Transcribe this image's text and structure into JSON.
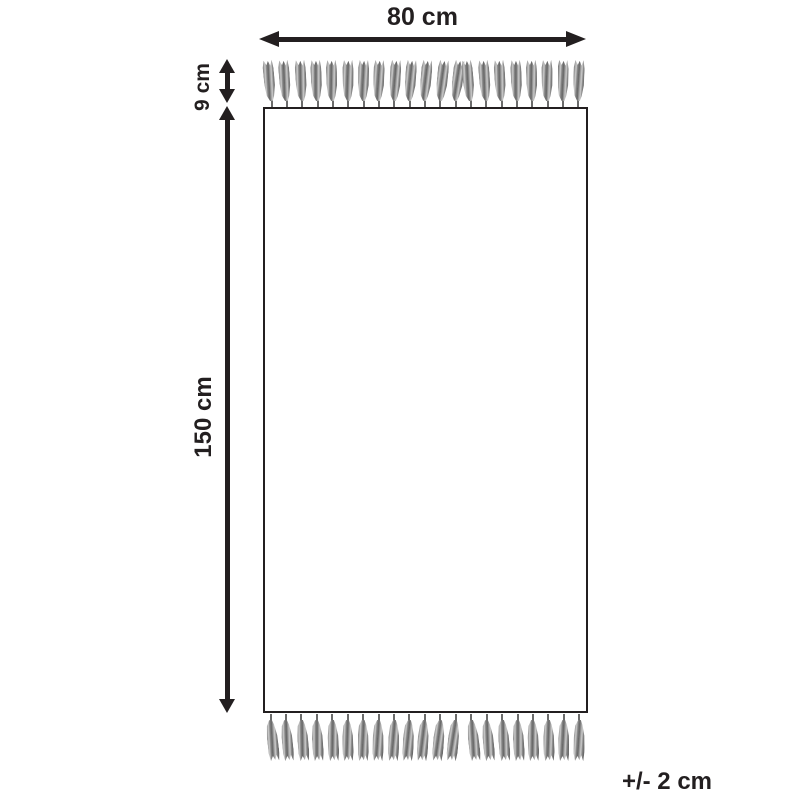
{
  "diagram": {
    "width_dimension": {
      "label": "80 cm"
    },
    "fringe_dimension": {
      "label": "9 cm"
    },
    "height_dimension": {
      "label": "150 cm"
    },
    "tolerance": {
      "label": "+/- 2 cm"
    },
    "fringe": {
      "top_tassel_count": 21,
      "bottom_tassel_count": 21
    },
    "colors": {
      "line": "#231f20",
      "tassel_gray": "#8a8a8a",
      "background": "#ffffff"
    }
  }
}
